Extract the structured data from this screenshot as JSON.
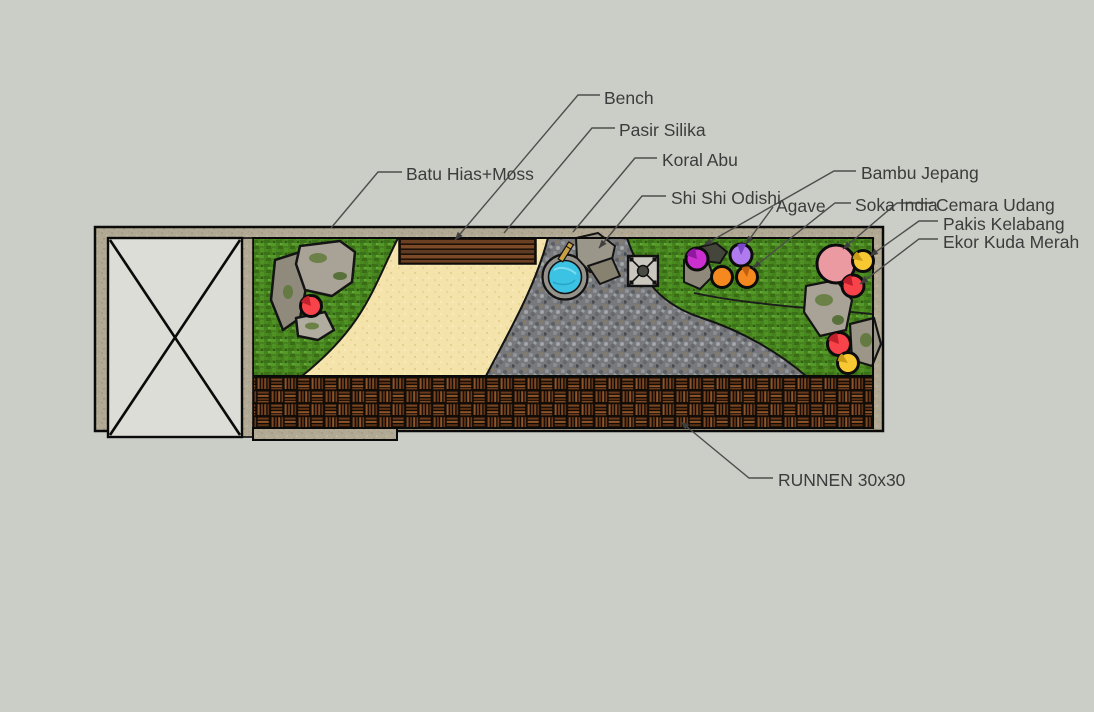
{
  "scene": {
    "title": "Garden landscape plan - top view",
    "style": "sketchup-render",
    "background_color": "#cbcec7"
  },
  "annotations": {
    "bench": {
      "text": "Bench",
      "target": "wooden bench against top wall"
    },
    "pasir_silika": {
      "text": "Pasir Silika",
      "target": "pale silica sand path"
    },
    "koral_abu": {
      "text": "Koral Abu",
      "target": "gray coral gravel sweep"
    },
    "shi_shi_odishi": {
      "text": "Shi Shi Odishi",
      "target": "round water basin with bamboo spout"
    },
    "batu_hias_moss": {
      "text": "Batu Hias+Moss",
      "target": "decorative mossy rocks left cluster"
    },
    "bambu_jepang": {
      "text": "Bambu Jepang",
      "target": "dark clump near magenta plant circle"
    },
    "agave": {
      "text": "Agave",
      "target": "purple plant circle"
    },
    "soka_india": {
      "text": "Soka India",
      "target": "orange plant circles"
    },
    "cemara_udang": {
      "text": "Cemara Udang",
      "target": "large pink plant circle"
    },
    "pakis_kelabang": {
      "text": "Pakis Kelabang",
      "target": "upper yellow plant circle"
    },
    "ekor_kuda_merah": {
      "text": "Ekor Kuda Merah",
      "target": "upper red plant circle"
    },
    "runnen": {
      "text": "RUNNEN 30x30",
      "target": "dark wooden deck tile strip"
    }
  },
  "plan": {
    "structure_cell": {
      "description": "empty existing structure marked with X cross",
      "fill": "#dcddd6"
    },
    "frame_color": "#b1a993",
    "zones": [
      {
        "name": "grass",
        "color": "#46831f"
      },
      {
        "name": "silica-sand",
        "color": "#f4e4ab"
      },
      {
        "name": "gray-gravel",
        "color": "#77797c"
      },
      {
        "name": "deck-tiles-runnen",
        "color": "#6b3b1d"
      }
    ],
    "features": [
      {
        "name": "bench",
        "color": "#6a3f22"
      },
      {
        "name": "water-basin",
        "water_color": "#3cc3e4",
        "rim_color": "#94928a"
      },
      {
        "name": "stone-drain-square",
        "color": "#cac7bf"
      },
      {
        "name": "mossy-rocks",
        "color": "#a8a396",
        "moss_color": "#6c8148"
      }
    ],
    "plants": [
      {
        "name": "bambu-jepang-symbol",
        "shape": "dark clump",
        "color": "#44463c",
        "cx": 710,
        "cy": 253
      },
      {
        "name": "agave-symbol",
        "shape": "circle",
        "color": "#cb2fd0",
        "cx": 697,
        "cy": 259
      },
      {
        "name": "purple-plant",
        "shape": "circle",
        "color": "#b07bee",
        "cx": 741,
        "cy": 255
      },
      {
        "name": "soka-india-1",
        "shape": "circle",
        "color": "#f5891f",
        "cx": 722,
        "cy": 277
      },
      {
        "name": "soka-india-2",
        "shape": "circle",
        "color": "#f5891f",
        "cx": 747,
        "cy": 277
      },
      {
        "name": "cemara-udang-symbol",
        "shape": "circle",
        "color": "#eb9aa2",
        "cx": 836,
        "cy": 264
      },
      {
        "name": "pakis-kelabang-symbol",
        "shape": "circle",
        "color": "#f8c832",
        "cx": 863,
        "cy": 261
      },
      {
        "name": "ekor-kuda-merah-symbol",
        "shape": "circle",
        "color": "#f8434b",
        "cx": 853,
        "cy": 286
      },
      {
        "name": "red-plant-left",
        "shape": "circle",
        "color": "#f8434b",
        "cx": 311,
        "cy": 306
      },
      {
        "name": "red-plant-lower",
        "shape": "circle",
        "color": "#f8434b",
        "cx": 839,
        "cy": 344
      },
      {
        "name": "yellow-plant-lower",
        "shape": "circle",
        "color": "#f8c832",
        "cx": 848,
        "cy": 363
      }
    ]
  }
}
